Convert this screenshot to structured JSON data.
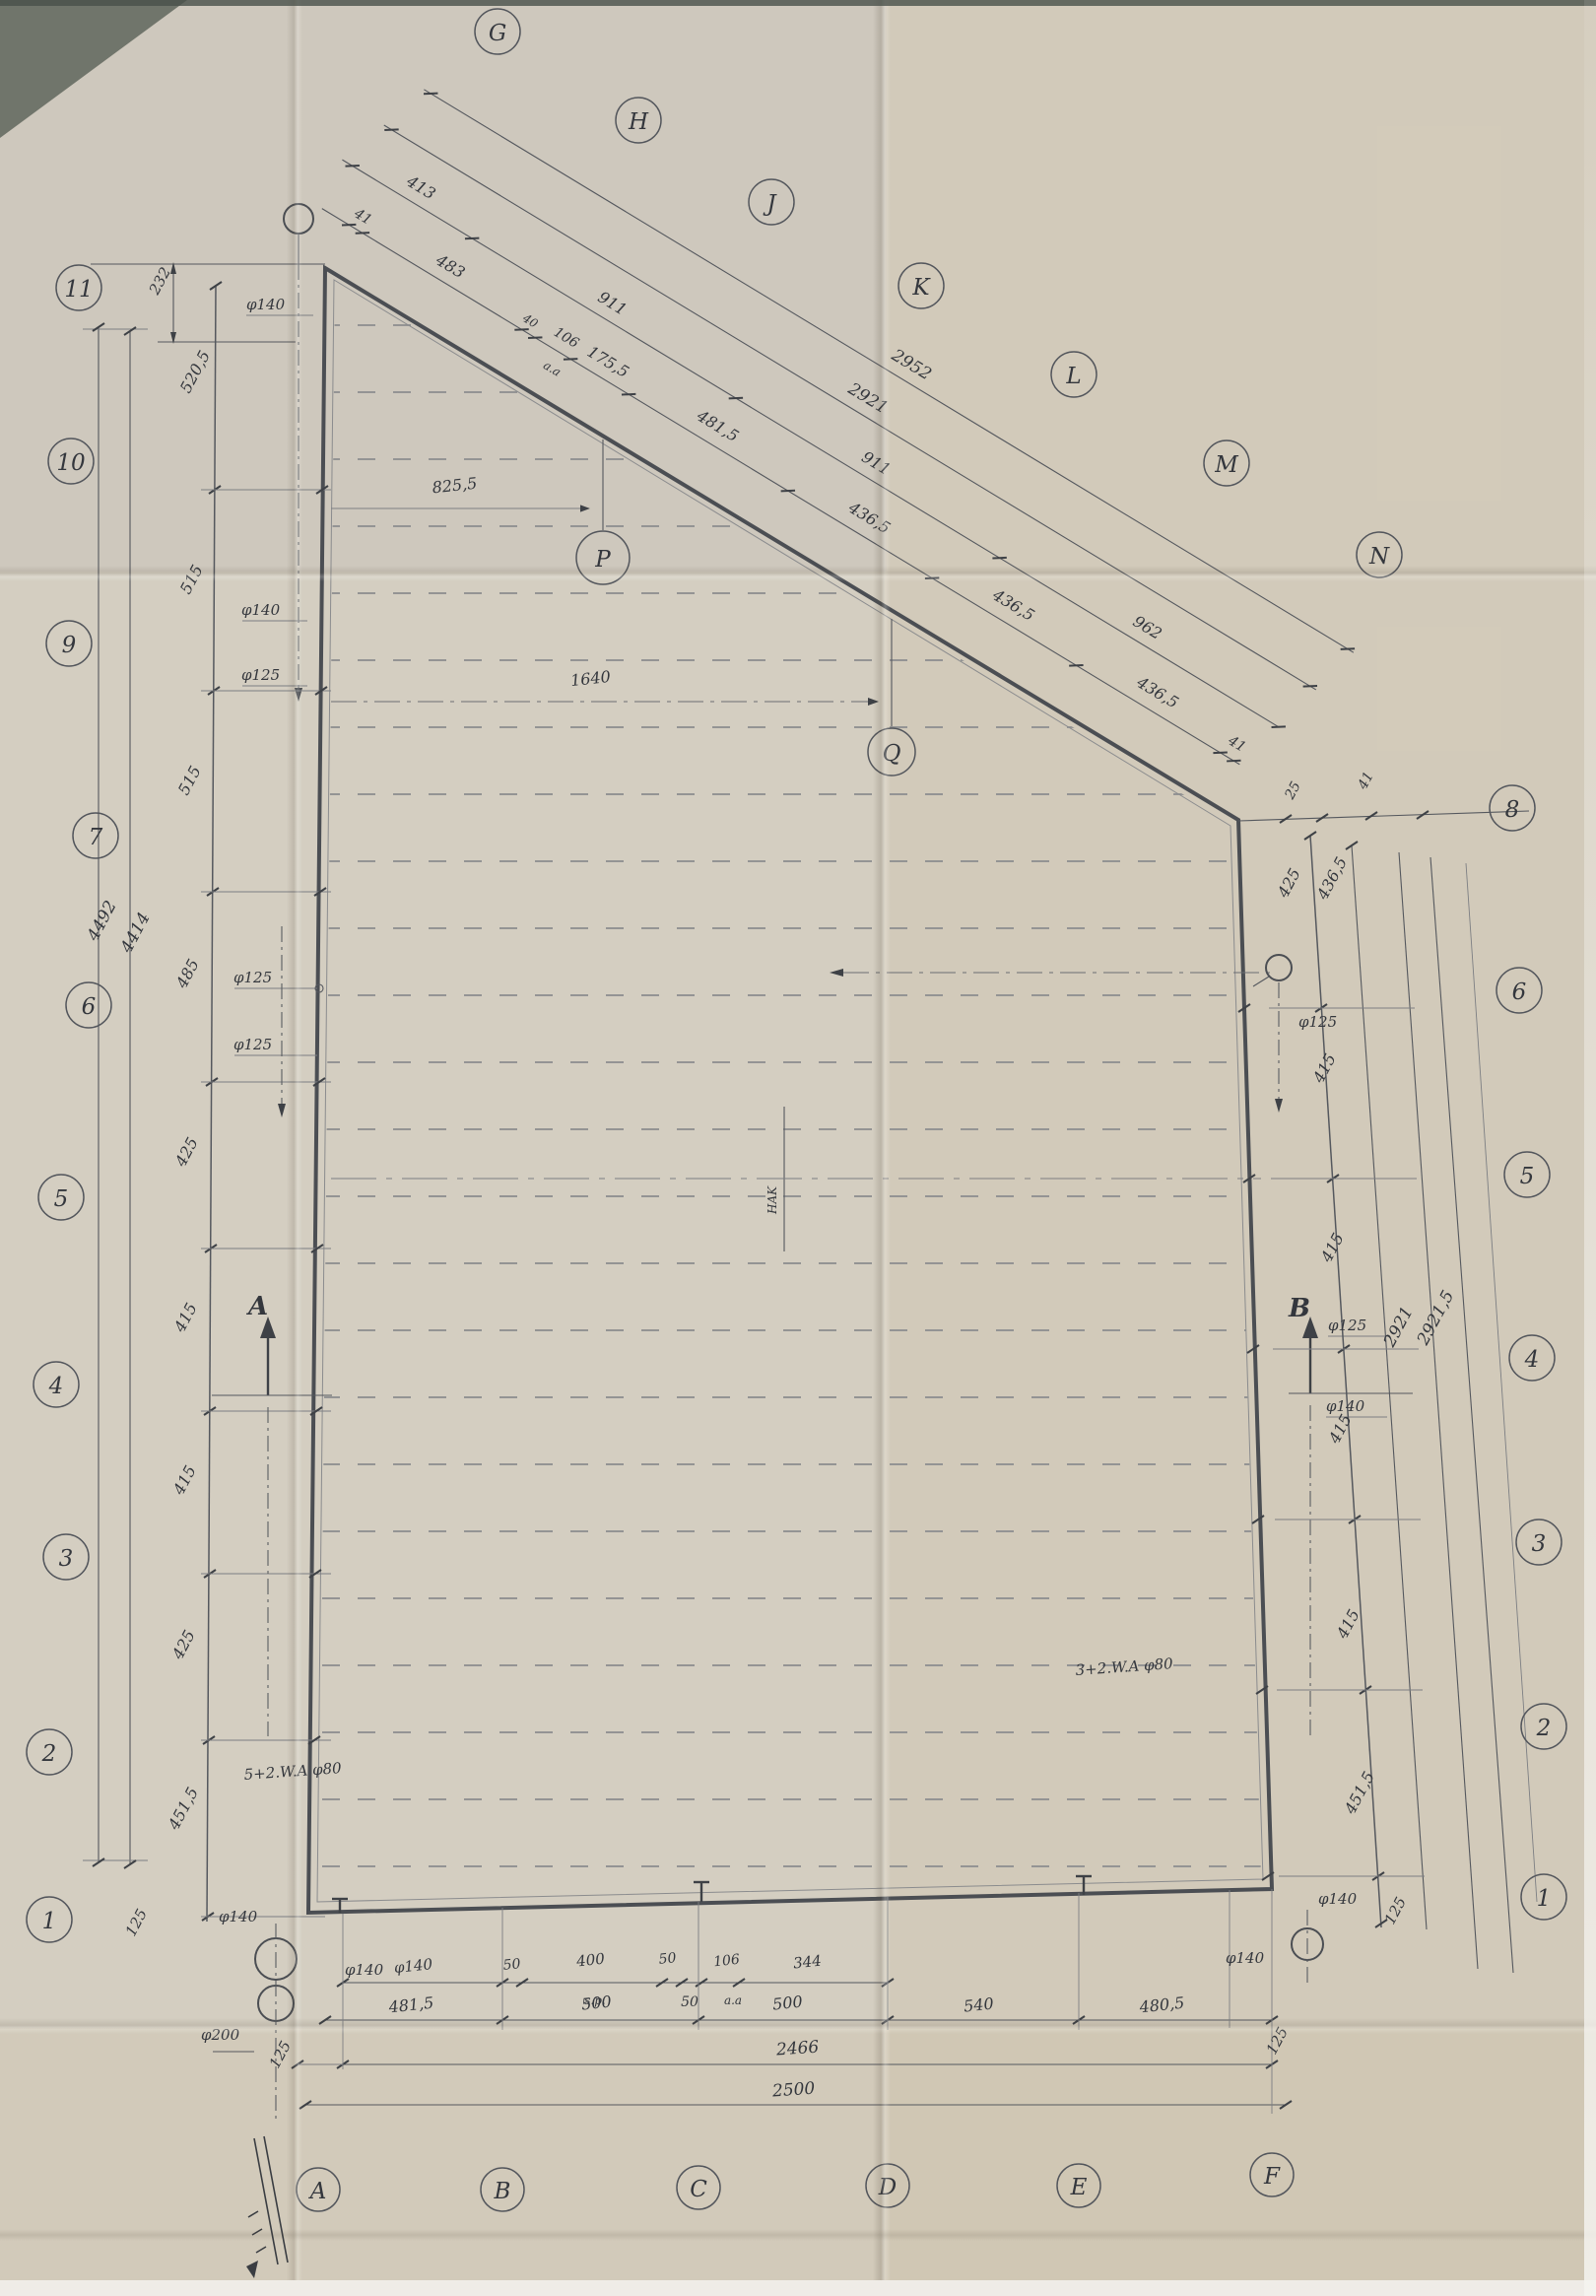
{
  "paper": {
    "base": "#d4cec1",
    "accent_line": "#4b4e53",
    "ink": "#34373d"
  },
  "grid": {
    "top_letters": [
      "G",
      "H",
      "J",
      "K",
      "L",
      "M",
      "N"
    ],
    "left_numbers": [
      "11",
      "10",
      "9",
      "7",
      "6",
      "5",
      "4",
      "3",
      "2",
      "1"
    ],
    "right_numbers": [
      "8",
      "6",
      "5",
      "4",
      "3",
      "2",
      "1"
    ],
    "bottom_letters": [
      "A",
      "B",
      "C",
      "D",
      "E",
      "F"
    ]
  },
  "interior": {
    "p": "P",
    "q": "Q",
    "hak": "HAK",
    "dim_to_p": "825,5",
    "dim_to_q": "1640",
    "wa_left": "5+2.W.A φ80",
    "wa_right": "3+2.W.A φ80",
    "section_a": "A",
    "section_b": "B"
  },
  "diag": {
    "small": [
      {
        "v": "41"
      },
      {
        "v": "483"
      },
      {
        "v": "40"
      },
      {
        "v": "106",
        "sub": "a.a"
      },
      {
        "v": "175,5"
      },
      {
        "v": "481,5"
      },
      {
        "v": "436,5"
      },
      {
        "v": "436,5"
      },
      {
        "v": "436,5"
      },
      {
        "v": "41"
      }
    ],
    "mid": [
      "413",
      "911",
      "911",
      "962"
    ],
    "outer": [
      "2921",
      "2952"
    ]
  },
  "left": {
    "top": "232",
    "segments": [
      "520,5",
      "515",
      "515",
      "485",
      "425",
      "415",
      "415",
      "425",
      "451,5"
    ],
    "bottom": "125",
    "overall": [
      "4492",
      "4414"
    ],
    "callouts": [
      "φ140",
      "φ140",
      "φ125",
      "φ125",
      "φ125"
    ]
  },
  "right": {
    "knee": [
      "25",
      "41"
    ],
    "inner_top": "425",
    "outer_top": "436,5",
    "segments": [
      "415",
      "415",
      "415",
      "415",
      "451,5",
      "125"
    ],
    "overall": [
      "2921",
      "2921,5"
    ],
    "callouts": [
      "φ125",
      "φ125",
      "φ140"
    ]
  },
  "bottom": {
    "small": [
      {
        "v": "φ140"
      },
      {
        "v": "50"
      },
      {
        "v": "400",
        "sub": "s.p."
      },
      {
        "v": "50"
      },
      {
        "v": "50"
      },
      {
        "v": "106",
        "sub": "a.a"
      },
      {
        "v": "344"
      }
    ],
    "mid": [
      "481,5",
      "500",
      "500",
      "540",
      "480,5"
    ],
    "offset_left": "125",
    "offset_right": "125",
    "overall": [
      "2466",
      "2500"
    ],
    "callouts_left": [
      "φ140",
      "φ140",
      "φ200"
    ],
    "callouts_right": [
      "φ140",
      "φ140"
    ]
  }
}
